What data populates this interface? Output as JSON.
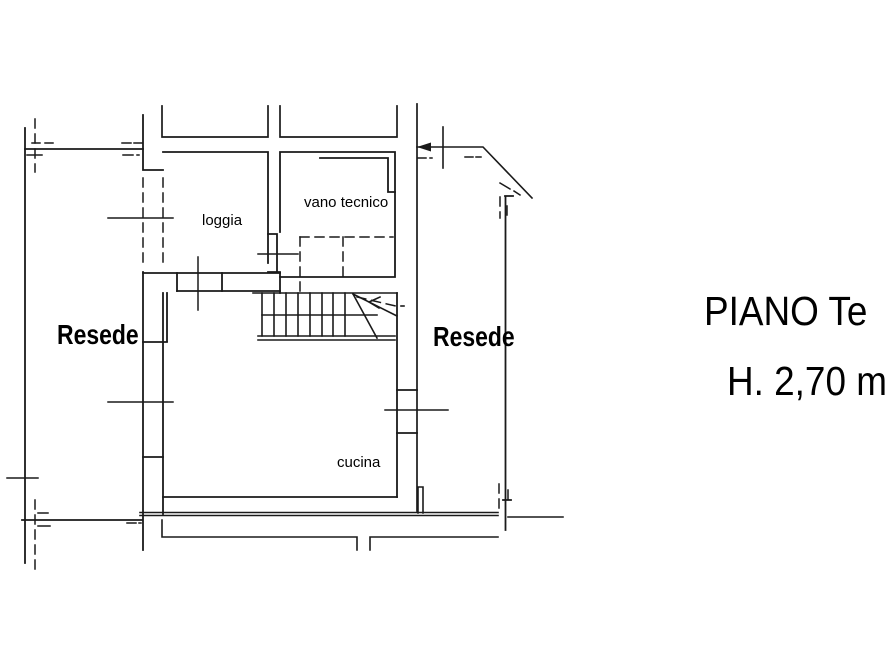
{
  "canvas": {
    "background": "#ffffff",
    "line_color": "#1a1a1a",
    "text_color": "#000000"
  },
  "labels": {
    "loggia": "loggia",
    "vano_tecnico": "vano tecnico",
    "cucina": "cucina",
    "resede_left": "Resede",
    "resede_right": "Resede"
  },
  "title": {
    "line1": "PIANO Te",
    "line2": "H. 2,70 m"
  }
}
